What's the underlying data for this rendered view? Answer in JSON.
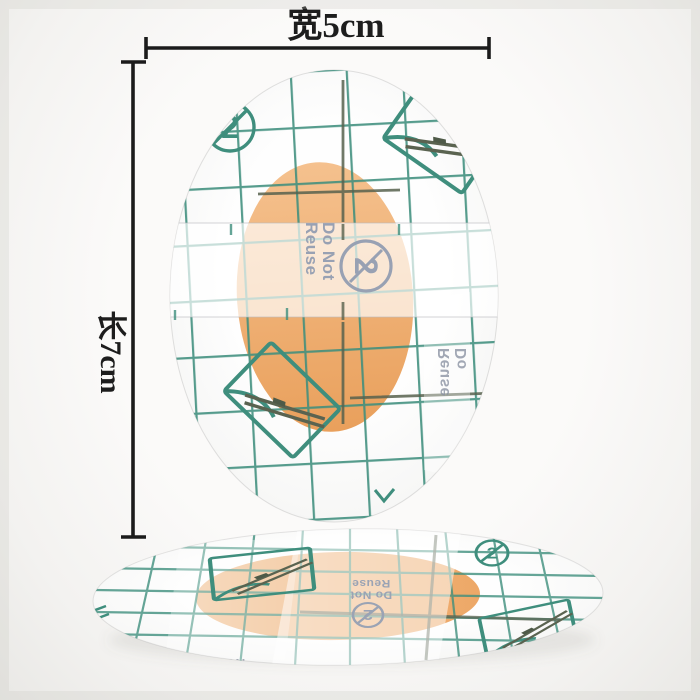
{
  "annotations": {
    "width_label": "宽5cm",
    "length_label": "长7cm"
  },
  "main_bandage": {
    "release_tab_text": {
      "line1": "Do Not",
      "line2": "Reuse"
    },
    "back_print_text": {
      "line1": "Reuse",
      "line2": "Do"
    },
    "no_reuse_glyph": "2",
    "icons": {
      "no_reuse": "no-reuse-crossed-2-icon",
      "peel_top_right": "peel-corner-application-icon",
      "peel_mid_left": "peel-corner-application-icon",
      "chevron": "chevron-mark-icon"
    }
  },
  "flat_bandage": {
    "release_tab_text": {
      "line1": "Do Not",
      "line2": "Reuse"
    },
    "back_print_text": {
      "line1": "Reuse"
    },
    "no_reuse_glyph": "2",
    "icons": {
      "no_reuse": "no-reuse-crossed-2-icon",
      "peel_left": "peel-corner-application-icon",
      "peel_right": "peel-corner-application-icon"
    }
  },
  "colors": {
    "background": "#f6f5f3",
    "grid_teal": "#3f8e7d",
    "grid_dark_olive": "#57624e",
    "pad_orange": "#efab6f",
    "tab_text_gray_blue": "#98a1b3",
    "dimension_ink": "#1d1d1d"
  }
}
